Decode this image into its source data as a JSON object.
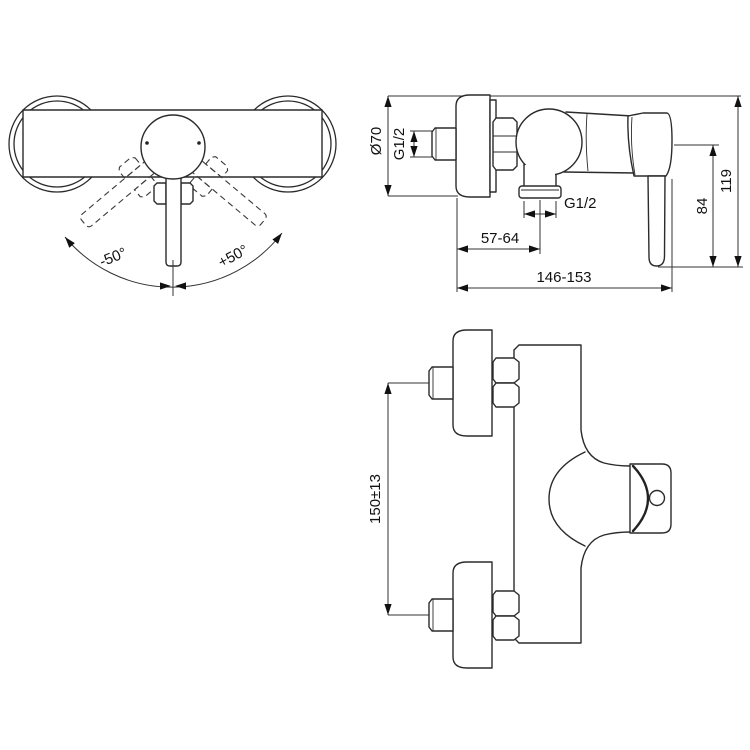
{
  "drawing": {
    "title": "shower-mixer-technical-drawing",
    "colors": {
      "line": "#2b2b2b",
      "background": "#ffffff",
      "text": "#111111"
    },
    "front_view": {
      "negative_angle": "-50°",
      "positive_angle": "+50°"
    },
    "side_view": {
      "rosette_diameter": "Ø70",
      "inlet_thread": "G1/2",
      "outlet_thread": "G1/2",
      "wall_to_outlet": "57-64",
      "total_depth": "146-153",
      "lever_height": "84",
      "total_height": "119"
    },
    "top_view": {
      "inlet_center_distance": "150±13"
    }
  }
}
